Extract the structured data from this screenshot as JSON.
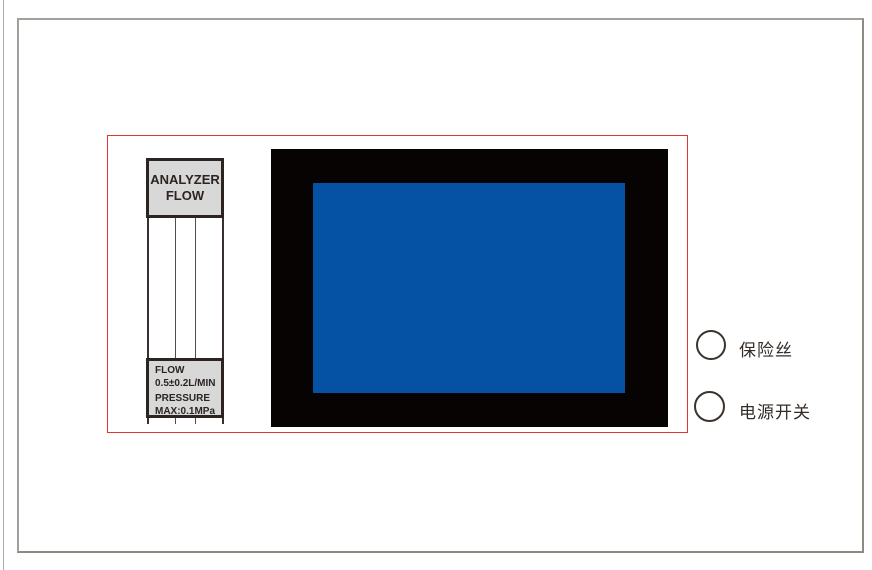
{
  "diagram": {
    "flow_meter": {
      "title_line1": "ANALYZER",
      "title_line2": "FLOW",
      "spec_line1": "FLOW",
      "spec_line2": "0.5±0.2L/MIN",
      "spec_line3": "PRESSURE",
      "spec_line4": "MAX:0.1MPa"
    },
    "controls": {
      "fuse": {
        "label": "保险丝"
      },
      "power_switch": {
        "label": "电源开关"
      }
    },
    "colors": {
      "panel_outline_red": "#e23531",
      "screen_bezel_black": "#070303",
      "screen_blue": "#0552a4",
      "label_plate_fill": "#d8d8d8",
      "line_dark": "#2c2421",
      "page_border_gray": "#8e8983"
    }
  }
}
